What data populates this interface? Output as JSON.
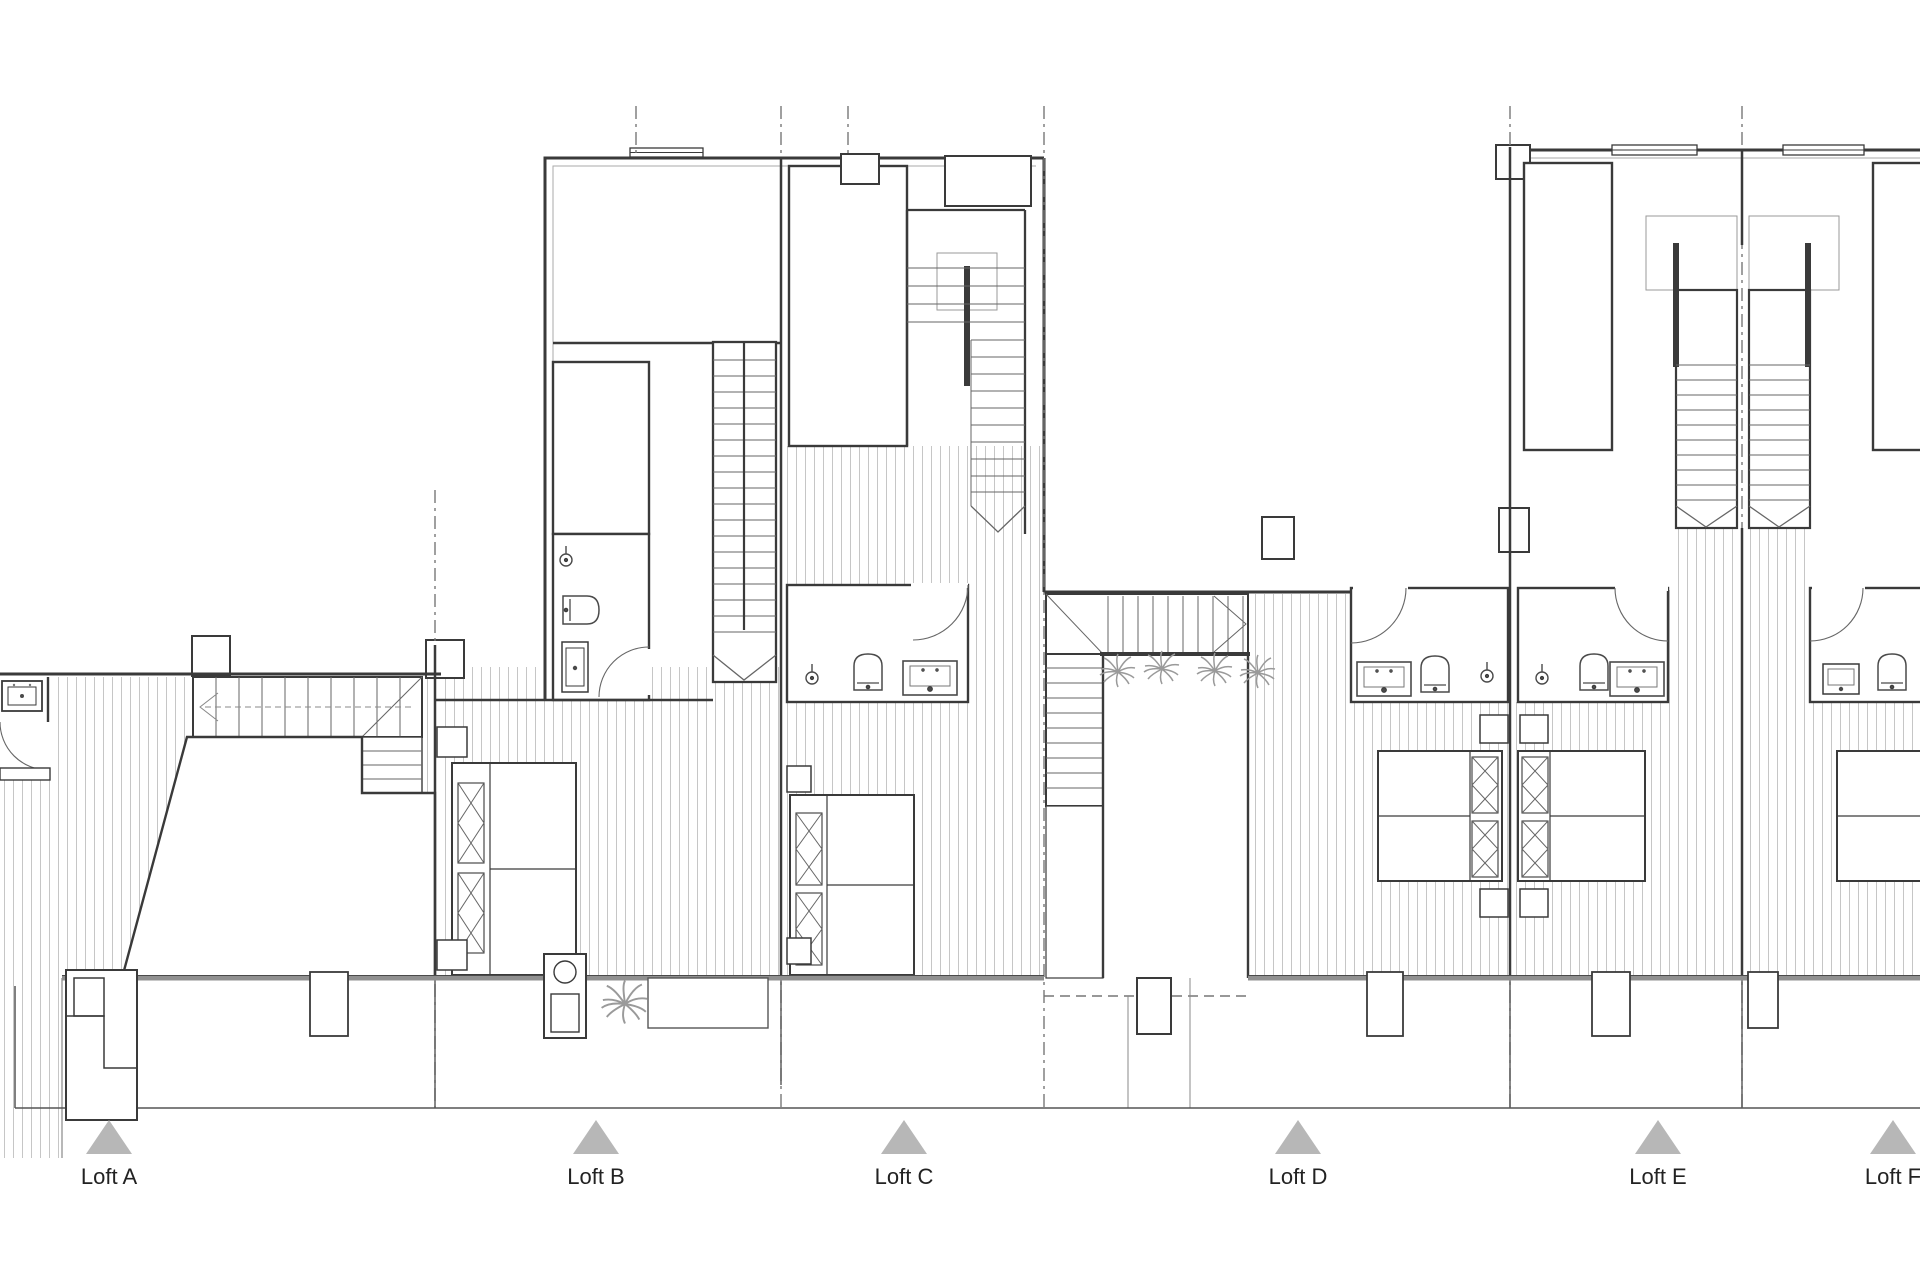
{
  "title": "Upper Floor",
  "lofts": [
    {
      "label": "Loft A"
    },
    {
      "label": "Loft B"
    },
    {
      "label": "Loft C"
    },
    {
      "label": "Loft D"
    },
    {
      "label": "Loft E"
    },
    {
      "label": "Loft F"
    }
  ],
  "colors": {
    "wall_line": "#3a3a3a",
    "hatch_line": "#c6c6c6",
    "title_gray": "#8a8a8a",
    "marker_gray": "#b7b7b7",
    "terrace_wall_gray": "#909090",
    "plant_gray": "#9a9a9a"
  }
}
